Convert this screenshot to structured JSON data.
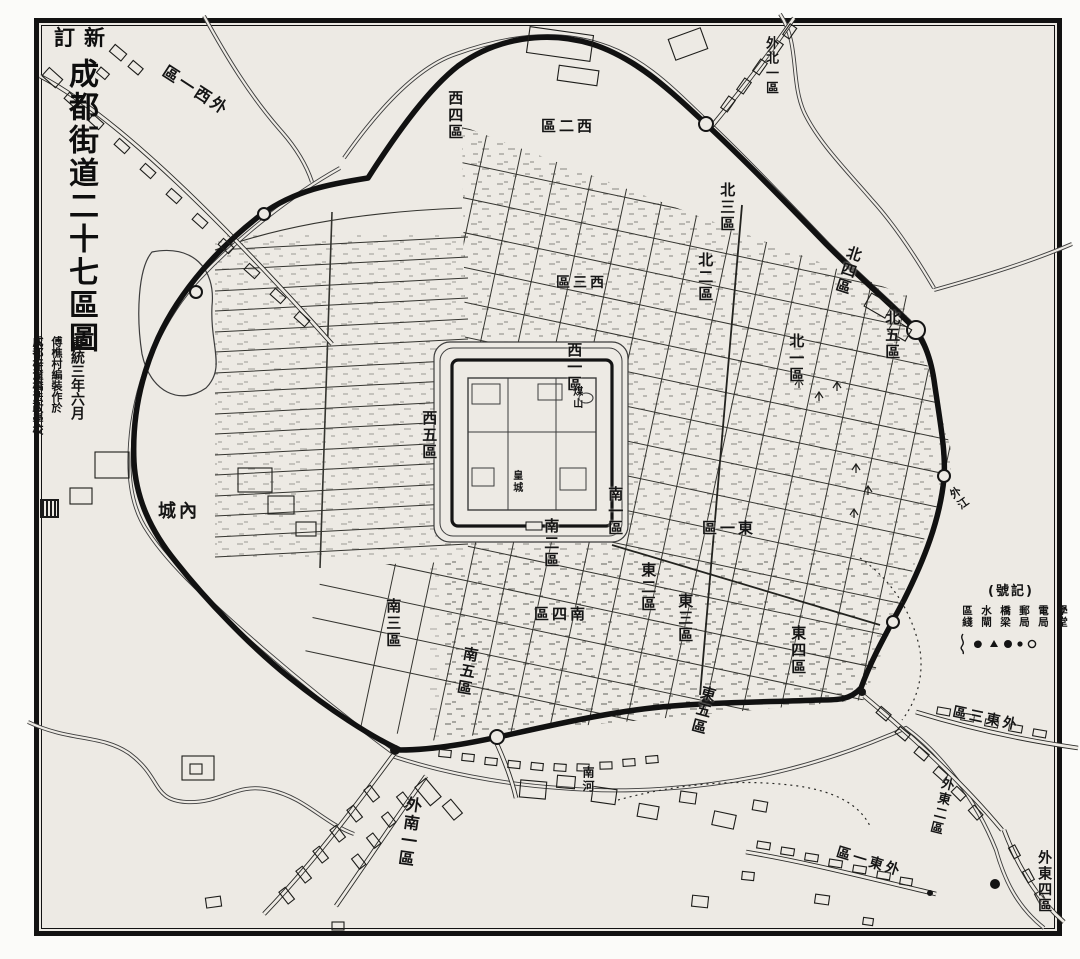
{
  "title": {
    "prefix_reading": "新訂",
    "prefix_display": "訂新",
    "main": "成都街道二十七區圖"
  },
  "colophon": {
    "date": "宣統三年六月",
    "author_line": "傅樵村編裝作於",
    "place_line": "成都梓潼橋法政學校"
  },
  "legend": {
    "title_reading": "記號",
    "title_display": "(號記)",
    "items": [
      {
        "reading": "區綫",
        "symbol": "wavy-line"
      },
      {
        "reading": "水閘",
        "symbol": "blob"
      },
      {
        "reading": "橋梁",
        "symbol": "triangle"
      },
      {
        "reading": "郵局",
        "symbol": "large-dot"
      },
      {
        "reading": "電局",
        "symbol": "small-dot"
      },
      {
        "reading": "學堂",
        "symbol": "circle"
      }
    ]
  },
  "districts": [
    {
      "name": "西一區",
      "display": "西一區"
    },
    {
      "name": "西二區",
      "display": "區二西"
    },
    {
      "name": "西三區",
      "display": "區三西"
    },
    {
      "name": "西四區",
      "display": "西四區"
    },
    {
      "name": "西五區",
      "display": "西五區"
    },
    {
      "name": "北一區",
      "display": "北一區"
    },
    {
      "name": "北二區",
      "display": "北二區"
    },
    {
      "name": "北三區",
      "display": "北三區"
    },
    {
      "name": "北四區",
      "display": "北四區"
    },
    {
      "name": "北五區",
      "display": "北五區"
    },
    {
      "name": "東一區",
      "display": "區一東"
    },
    {
      "name": "東二區",
      "display": "東二區"
    },
    {
      "name": "東三區",
      "display": "東三區"
    },
    {
      "name": "東四區",
      "display": "東四區"
    },
    {
      "name": "東五區",
      "display": "東五區"
    },
    {
      "name": "南一區",
      "display": "南一區"
    },
    {
      "name": "南二區",
      "display": "南二區"
    },
    {
      "name": "南三區",
      "display": "南三區"
    },
    {
      "name": "南四區",
      "display": "區四南"
    },
    {
      "name": "南五區",
      "display": "南五區"
    },
    {
      "name": "外西一區",
      "display": "區一西外"
    },
    {
      "name": "外北一區",
      "display": "外北一區"
    },
    {
      "name": "外南一區",
      "display": "外南一區"
    },
    {
      "name": "外東一區",
      "display": "區一東外"
    },
    {
      "name": "外東二區",
      "display": "外東二區"
    },
    {
      "name": "外東三區",
      "display": "區三東外"
    },
    {
      "name": "外東四區",
      "display": "外東四區"
    }
  ],
  "features": [
    {
      "name": "內城",
      "display": "城內"
    },
    {
      "name": "皇城",
      "display": "皇城"
    },
    {
      "name": "煤山",
      "display": "煤山"
    },
    {
      "name": "南河",
      "display": "南河"
    },
    {
      "name": "外江",
      "display": "外江"
    }
  ],
  "colors": {
    "paper": "#edeae4",
    "ink": "#141414",
    "line": "#3c3c3c"
  }
}
